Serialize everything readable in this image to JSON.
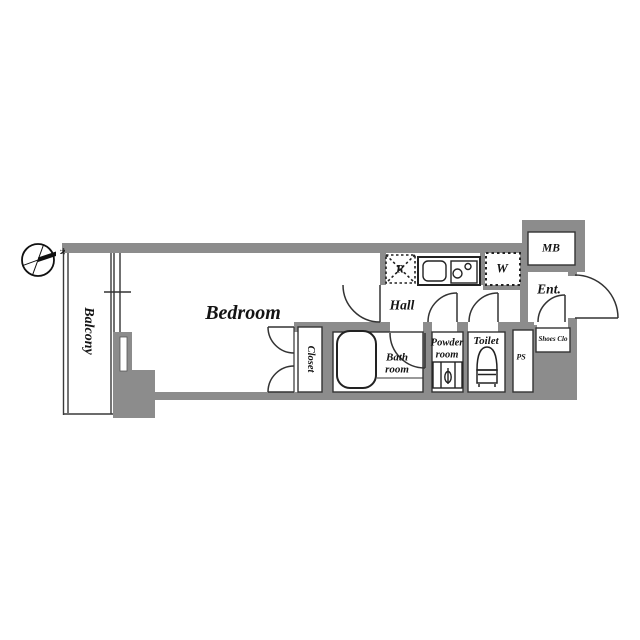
{
  "title": "apartment-floor-plan",
  "compass": {
    "label": "N"
  },
  "labels": {
    "balcony": "Balcony",
    "bedroom": "Bedroom",
    "hall": "Hall",
    "closet": "Closet",
    "bath": [
      "Bath",
      "room"
    ],
    "powder": [
      "Powder",
      "room"
    ],
    "toilet": "Toilet",
    "ps": "PS",
    "shoes": "Shoes Clo",
    "mb": "MB",
    "ent": "Ent.",
    "fridge": "R",
    "washer": "W"
  },
  "icons": {
    "compass": "compass-rose-icon",
    "bathtub": "bathtub-icon",
    "toilet": "toilet-icon",
    "sink": "kitchen-sink-icon",
    "stove": "stove-burners-icon",
    "vanity": "washbasin-icon",
    "window": "sliding-window-icon",
    "doors": "door-swing-arc-icon"
  },
  "colors": {
    "wall": "#8c8c8c",
    "line": "#333333",
    "text": "#141414",
    "background": "#ffffff"
  }
}
